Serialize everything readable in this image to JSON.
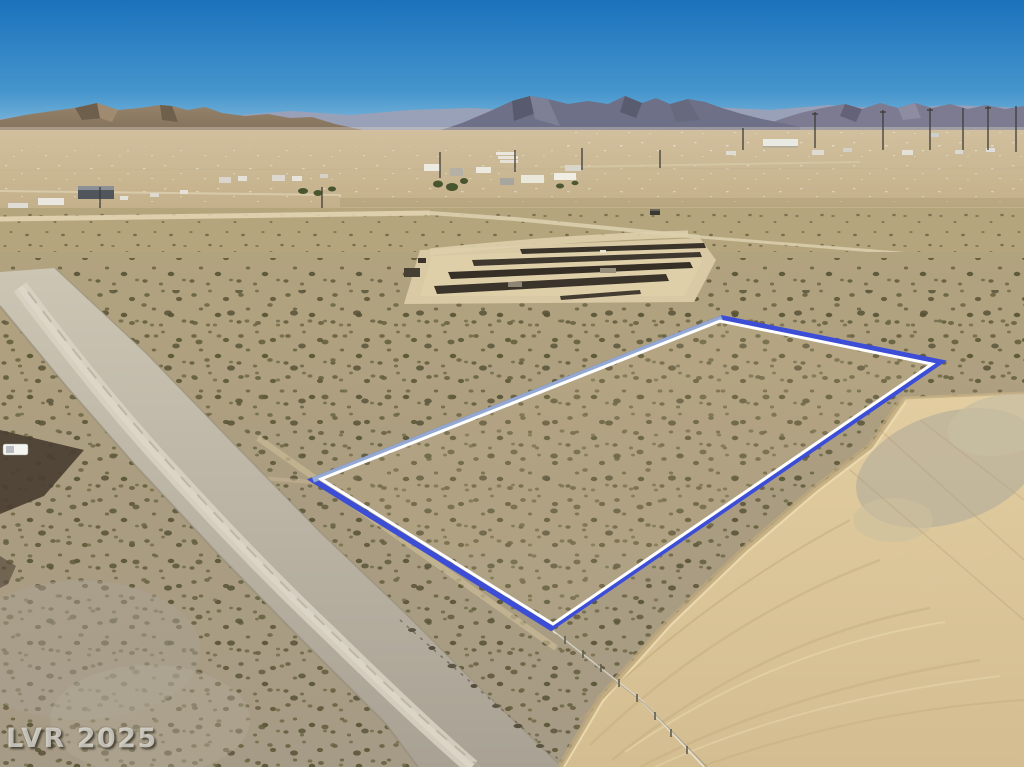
{
  "watermark": {
    "text": "LVR 2025"
  },
  "scene": {
    "description": "Aerial drone photograph of a vacant desert land parcel outlined in blue and white, beside a dirt road and a graded sand pad, with a construction staging area, scattered rural buildings, a desert valley town and mountain ranges on the horizon under a clear blue sky.",
    "sky": {
      "top_color": "#1b72bc",
      "mid_color": "#4696cd",
      "horizon_color": "#a3cbe2"
    },
    "mountains": {
      "far_ridge": "#99a1b9",
      "left_brown": "#8d7a63",
      "central": "#6d7086",
      "right": "#7c7b91"
    },
    "terrain": {
      "valley": "#c9b694",
      "desert_mid": "#b5a57d",
      "desert_foreground": "#ab9c80",
      "gravel_road": "#c3bcab",
      "graded_pad": "#ddc89c",
      "scrub": "#6e6847"
    },
    "parcel": {
      "outer_color": "#3d4ed6",
      "inner_color": "#ffffff",
      "upper_left_edge_color": "#93a9d4",
      "outer_points": "313,480 722,318 940,362 551,628",
      "inner_points": "321,479 720,321 932,364 553,624",
      "upper_left_edge": {
        "x1": "313",
        "y1": "480",
        "x2": "722",
        "y2": "318"
      }
    }
  }
}
